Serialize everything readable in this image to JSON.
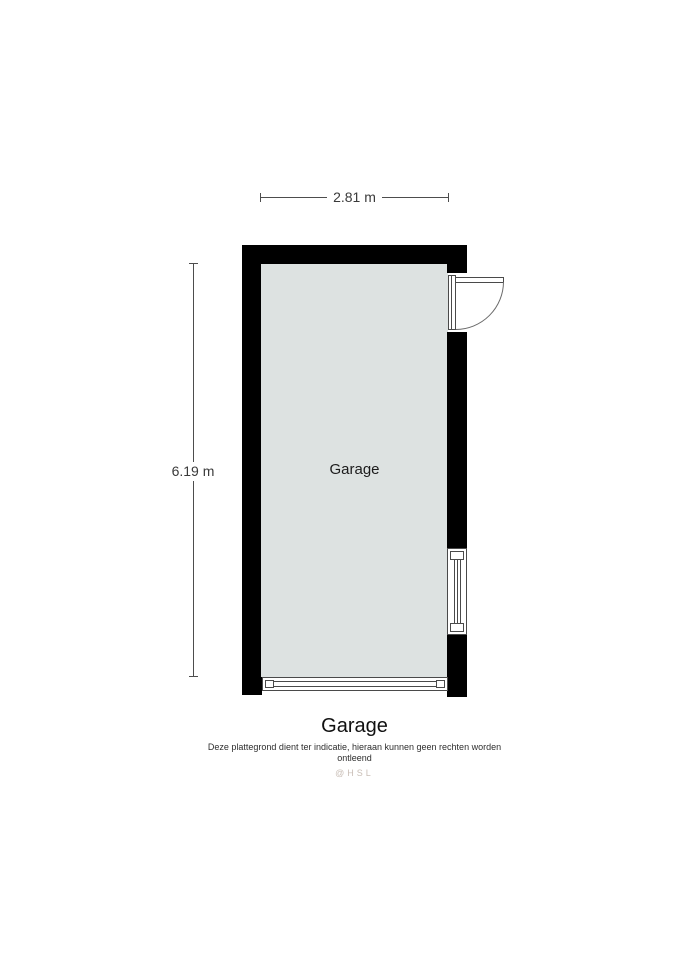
{
  "floorplan": {
    "room": {
      "label": "Garage"
    },
    "dimensions": {
      "width_label": "2.81 m",
      "height_label": "6.19 m"
    },
    "features": [
      {
        "name": "hinged-door",
        "location": "right wall, top, swings outward"
      },
      {
        "name": "window",
        "location": "right wall, lower section"
      },
      {
        "name": "garage-door",
        "location": "bottom wall, full width"
      }
    ]
  },
  "caption": {
    "title": "Garage",
    "disclaimer": "Deze plattegrond dient ter indicatie, hieraan kunnen geen rechten worden ontleend",
    "watermark": "@HSL"
  },
  "colors": {
    "wall": "#000000",
    "floor": "#dde2e1",
    "dimension_line": "#4d4d4d",
    "symbol_stroke": "#4a4a4a",
    "watermark": "#c9beb6"
  }
}
